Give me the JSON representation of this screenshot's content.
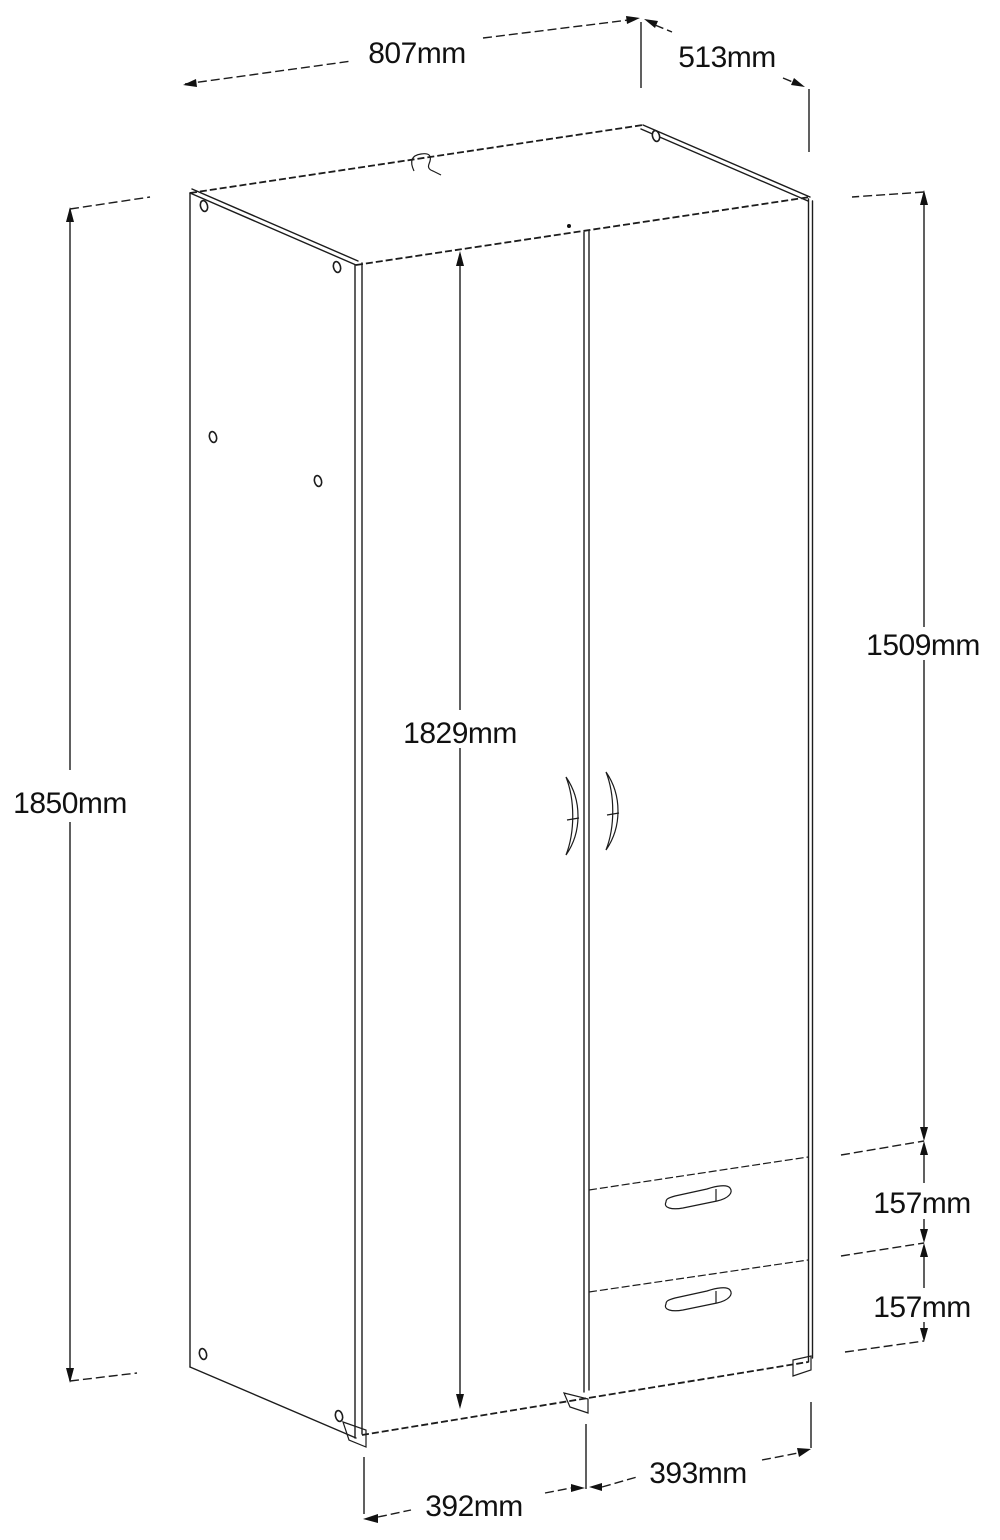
{
  "diagram": {
    "kind": "wardrobe-technical-drawing",
    "style": {
      "line_color": "#1c1c1c",
      "background": "#ffffff",
      "text_color": "#111111"
    },
    "dimensions": {
      "top_width": "807mm",
      "top_depth": "513mm",
      "overall_height": "1850mm",
      "door_height": "1829mm",
      "upper_section_height": "1509mm",
      "drawer1_height": "157mm",
      "drawer2_height": "157mm",
      "left_door_width": "392mm",
      "right_door_width": "393mm"
    }
  }
}
